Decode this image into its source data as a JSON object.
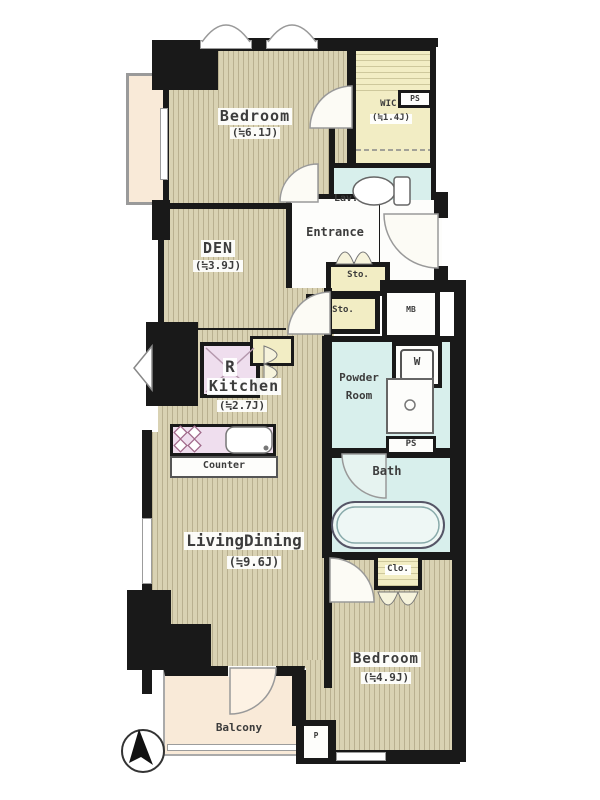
{
  "plan_title": "apartment-floor-plan",
  "rooms": {
    "bedroom1": {
      "name": "Bedroom",
      "size": "(≒6.1J)"
    },
    "wic": {
      "name": "WIC.",
      "size": "(≒1.4J)"
    },
    "ps_upper": {
      "name": "PS"
    },
    "lav": {
      "name": "Lav."
    },
    "entrance": {
      "name": "Entrance"
    },
    "den": {
      "name": "DEN",
      "size": "(≒3.9J)"
    },
    "sto_upper": {
      "name": "Sto."
    },
    "sto_lower": {
      "name": "Sto."
    },
    "mb": {
      "name": "MB"
    },
    "washer": {
      "name": "W"
    },
    "powder_room": {
      "line1": "Powder",
      "line2": "Room"
    },
    "ps_lower": {
      "name": "PS"
    },
    "bath": {
      "name": "Bath"
    },
    "refrigerator": {
      "name": "R"
    },
    "kitchen": {
      "name": "Kitchen",
      "size": "(≒2.7J)"
    },
    "counter": {
      "name": "Counter"
    },
    "living_dining": {
      "name": "LivingDining",
      "size": "(≒9.6J)"
    },
    "closet": {
      "name": "Clo."
    },
    "bedroom2": {
      "name": "Bedroom",
      "size": "(≒4.9J)"
    },
    "balcony": {
      "name": "Balcony"
    },
    "pipe_box": {
      "name": "P"
    }
  },
  "colors": {
    "floor_base": "#d9d2b3",
    "floor_line": "#b9b090",
    "closet_yellow": "#f2edc4",
    "wet_area_cyan": "#d8efec",
    "kitchen_pink": "#efdeee",
    "balcony_cream": "#f9ead8",
    "wall_black": "#191919"
  }
}
